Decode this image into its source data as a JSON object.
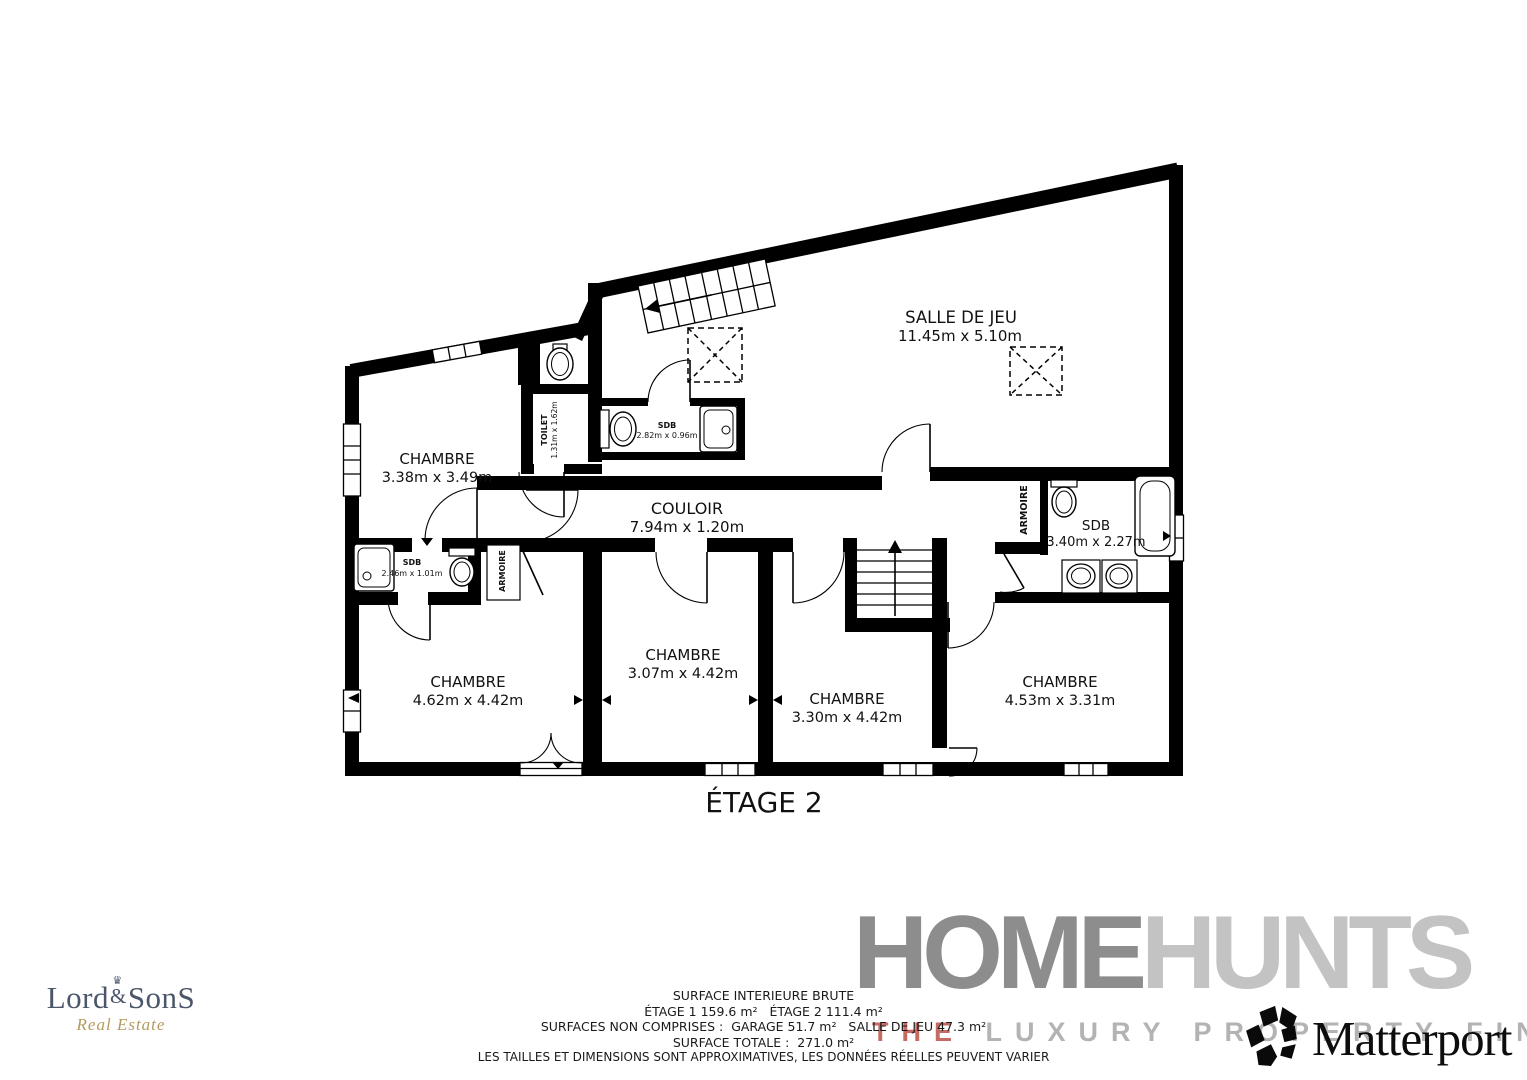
{
  "floor_title": "ÉTAGE 2",
  "rooms": {
    "salle_de_jeu": {
      "name": "SALLE DE JEU",
      "dims": "11.45m x 5.10m"
    },
    "chambre_nw": {
      "name": "CHAMBRE",
      "dims": "3.38m x 3.49m"
    },
    "toilet": {
      "name": "TOILET",
      "dims": "1.31m x 1.62m"
    },
    "sdb_top": {
      "name": "SDB",
      "dims": "2.82m x 0.96m"
    },
    "couloir": {
      "name": "COULOIR",
      "dims": "7.94m x 1.20m"
    },
    "sdb_left": {
      "name": "SDB",
      "dims": "2.46m x 1.01m"
    },
    "armoire_left": {
      "name": "ARMOIRE"
    },
    "armoire_right": {
      "name": "ARMOIRE"
    },
    "sdb_right": {
      "name": "SDB",
      "dims": "3.40m x 2.27m"
    },
    "chambre_sw": {
      "name": "CHAMBRE",
      "dims": "4.62m x 4.42m"
    },
    "chambre_s": {
      "name": "CHAMBRE",
      "dims": "3.07m x 4.42m"
    },
    "chambre_se": {
      "name": "CHAMBRE",
      "dims": "3.30m x 4.42m"
    },
    "chambre_e": {
      "name": "CHAMBRE",
      "dims": "4.53m x 3.31m"
    }
  },
  "footer": {
    "line1": "SURFACE INTERIEURE BRUTE",
    "line2": "ÉTAGE 1 159.6 m²   ÉTAGE 2 111.4 m²",
    "line3": "SURFACES NON COMPRISES :  GARAGE 51.7 m²   SALLE DE JEU 47.3 m²",
    "line4": "SURFACE TOTALE :  271.0 m²",
    "line5": "LES TAILLES ET DIMENSIONS SONT APPROXIMATIVES, LES DONNÉES RÉELLES PEUVENT VARIER"
  },
  "branding": {
    "lordsons": {
      "part1": "Lord",
      "amp": "&",
      "part2": "SonS",
      "tagline": "Real Estate",
      "crown": "♛"
    },
    "homehunts": {
      "home": "HOME",
      "hunts": "HUNTS",
      "tag_the": "THE ",
      "tag_rest": "LUXURY PROPERTY FINDERS"
    },
    "matterport": {
      "label": "Matterport"
    }
  },
  "colors": {
    "wall": "#000000",
    "homehunts_home": "#8d8d8d",
    "homehunts_hunts": "#c3c3c3",
    "tagline_the": "#c66b63",
    "lordsons_text": "#4b566a",
    "lordsons_gold": "#b49a5f"
  }
}
